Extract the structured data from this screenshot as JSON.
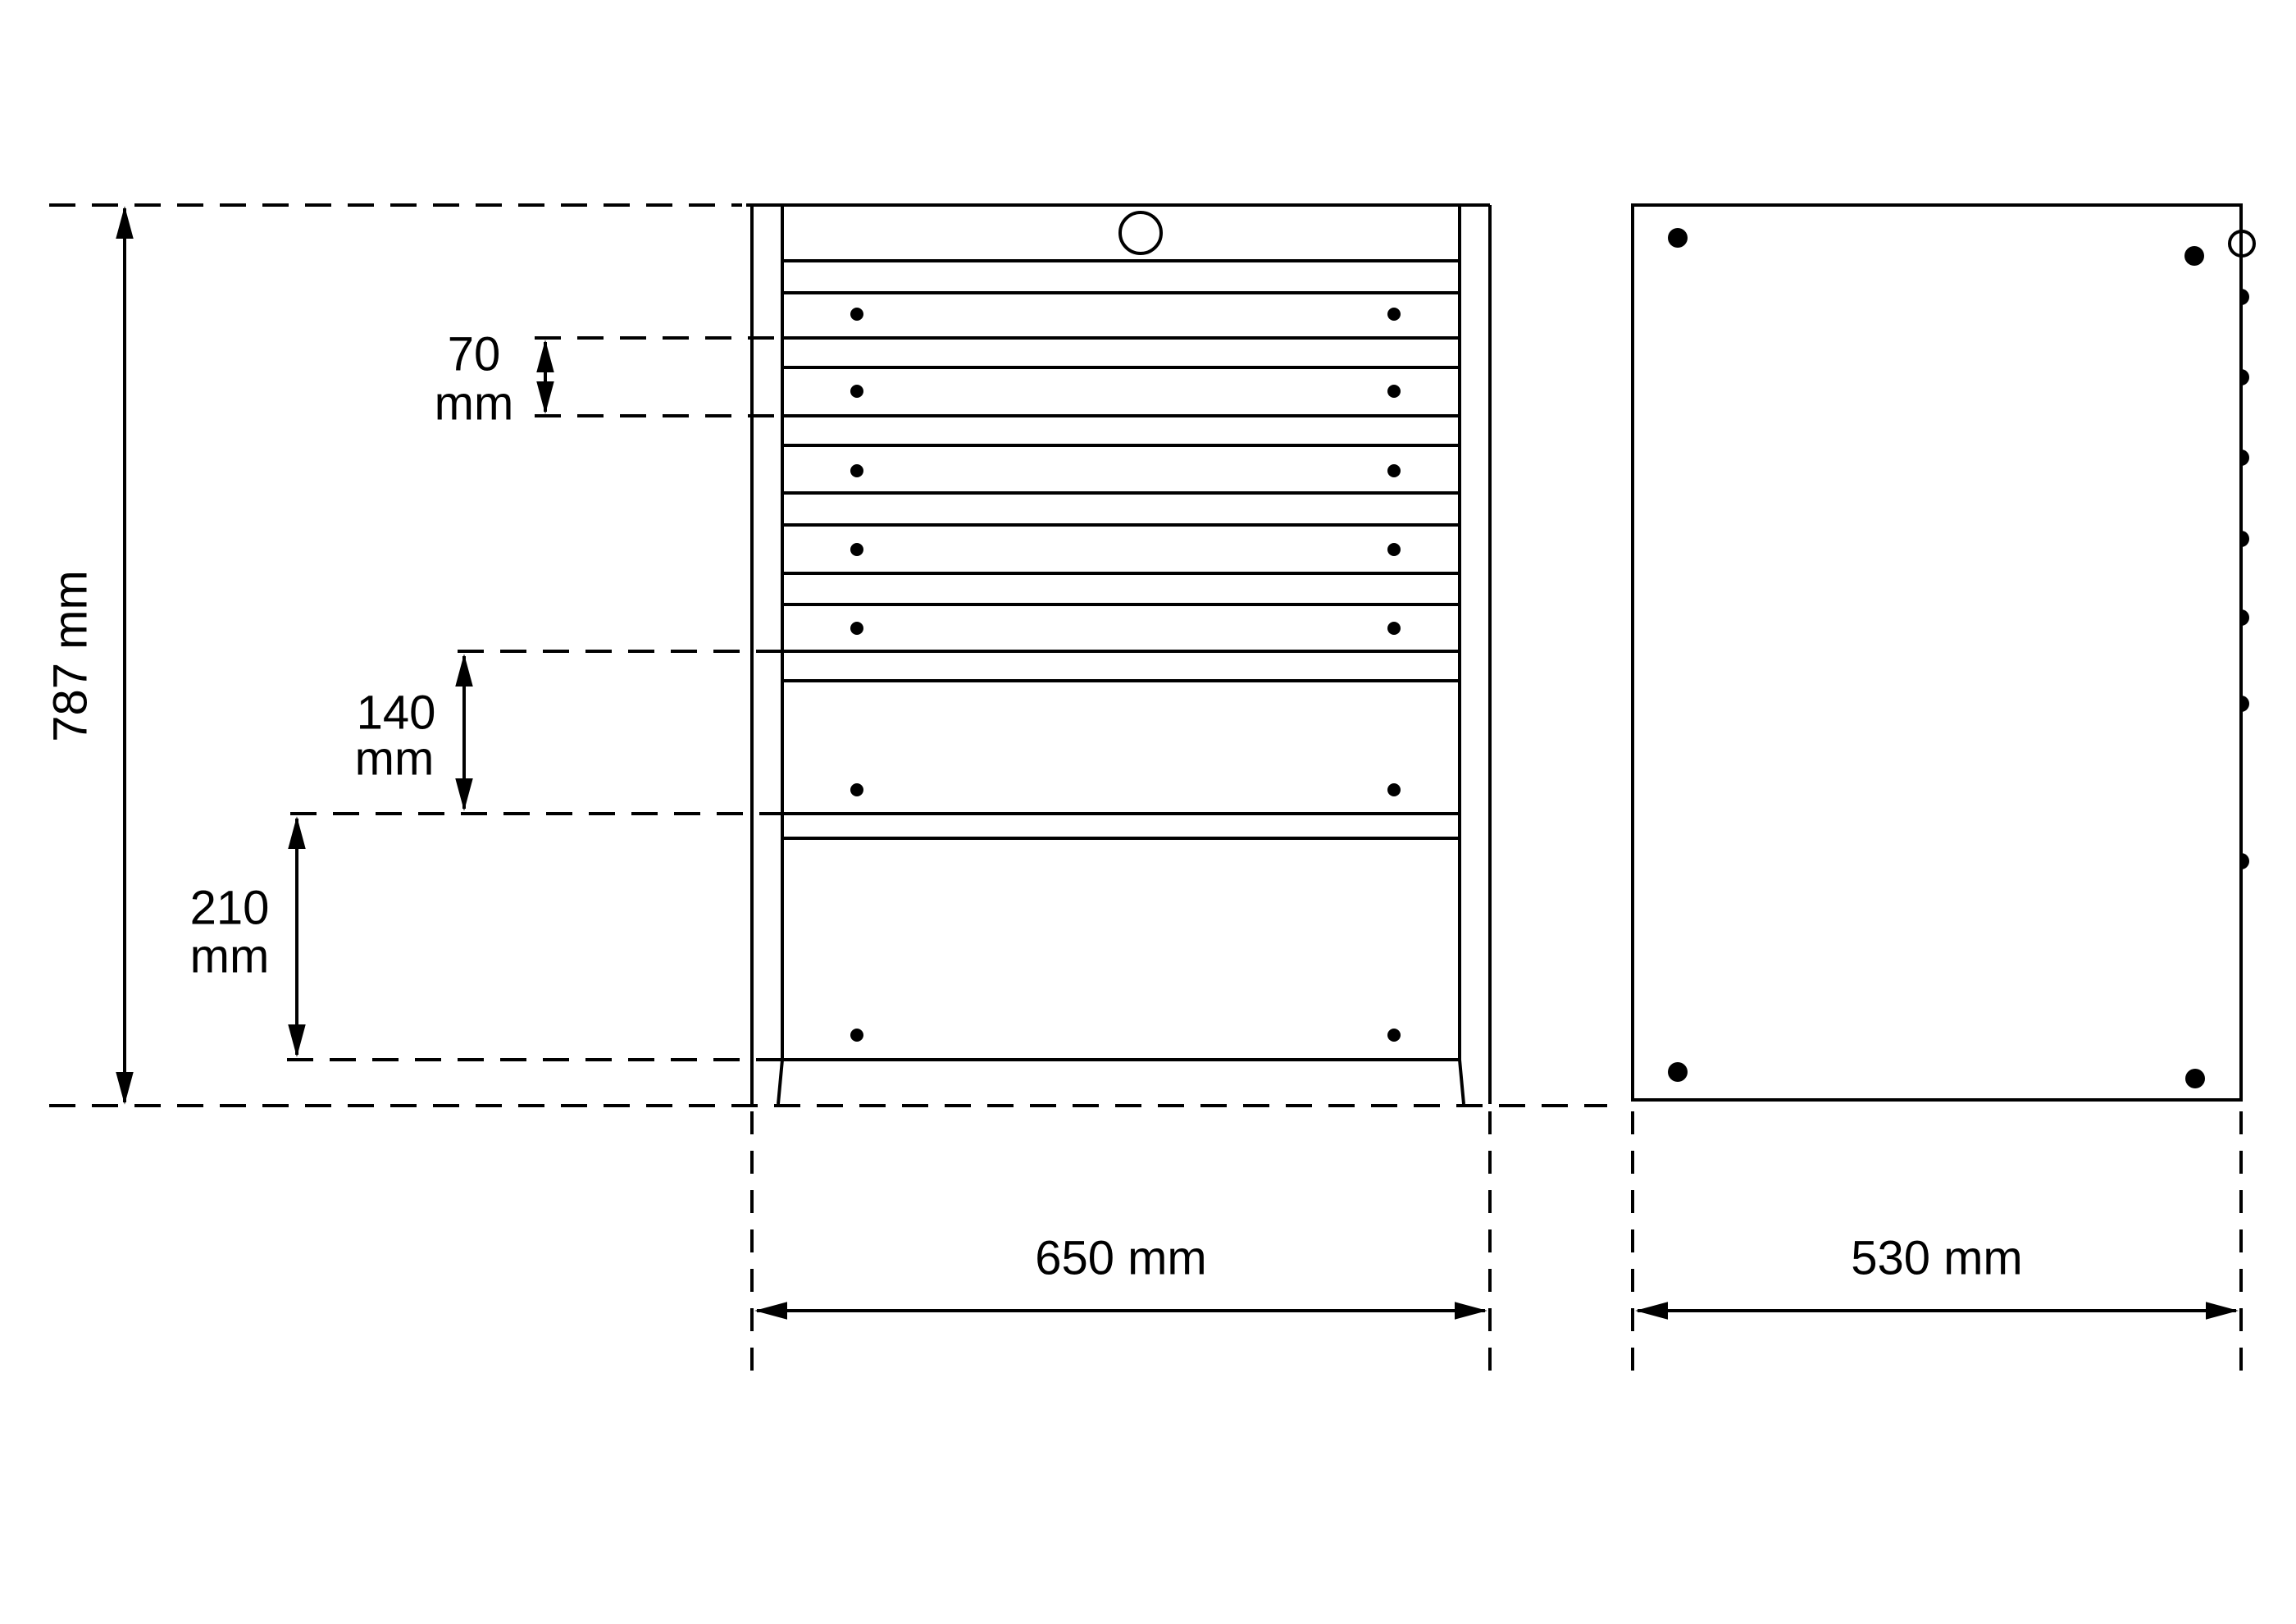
{
  "drawing": {
    "type": "technical-dimension-drawing",
    "subject": "drawer-cabinet-front-and-side-views",
    "background_color": "#ffffff",
    "line_color": "#000000",
    "dimensions": {
      "height": {
        "text": "787 mm",
        "value": 787,
        "unit": "mm"
      },
      "drawer_pitch": {
        "value": "70",
        "unit": "mm"
      },
      "medium_drawer": {
        "value": "140",
        "unit": "mm"
      },
      "large_drawer": {
        "value": "210",
        "unit": "mm"
      },
      "width": {
        "text": "650 mm",
        "value": 650,
        "unit": "mm"
      },
      "depth": {
        "text": "530 mm",
        "value": 530,
        "unit": "mm"
      }
    },
    "front_view": {
      "small_drawers": 5,
      "medium_drawers": 1,
      "large_drawers": 1,
      "handle_dots_per_drawer": 2,
      "lock_icon": "circle-outline"
    },
    "side_view": {
      "corner_bolts": 4,
      "edge_bumps": 7,
      "lock_icon": "half-circle-outline"
    }
  }
}
